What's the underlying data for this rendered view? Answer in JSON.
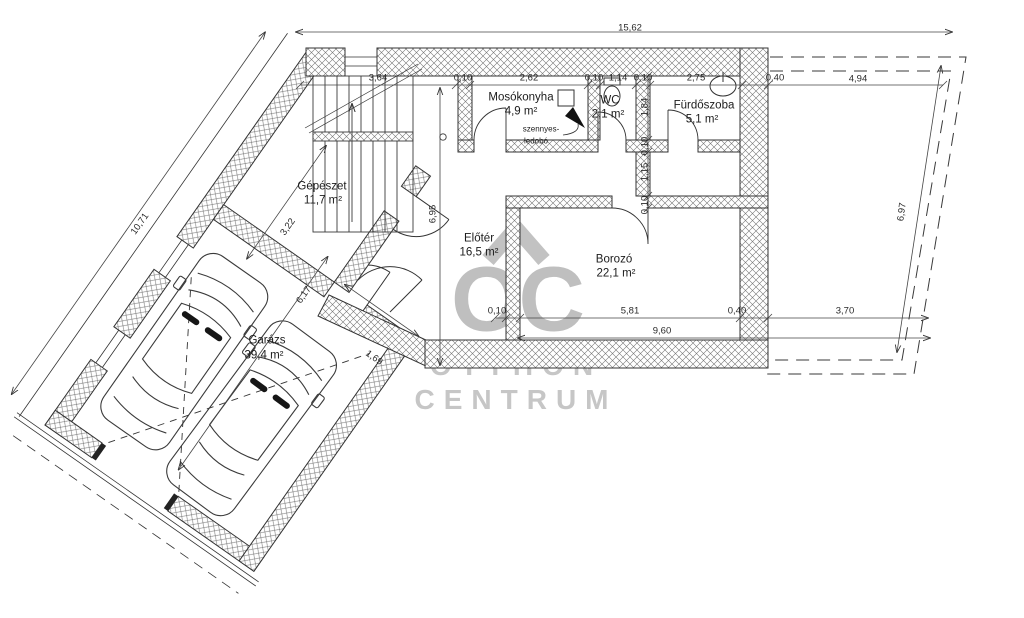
{
  "brand": {
    "oc": "OC",
    "line1": "OTTHON",
    "line2": "CENTRUM"
  },
  "rooms": {
    "mosokonyha": {
      "name": "Mosókonyha",
      "area": "4,9 m²"
    },
    "wc": {
      "name": "WC",
      "area": "2,1 m²"
    },
    "furdoszoba": {
      "name": "Fürdőszoba",
      "area": "5,1 m²"
    },
    "gepeszet": {
      "name": "Gépészet",
      "area": "11,7 m²"
    },
    "eloter": {
      "name": "Előtér",
      "area": "16,5 m²"
    },
    "borozo": {
      "name": "Borozó",
      "area": "22,1 m²"
    },
    "garazs": {
      "name": "Garázs",
      "area": "39,4 m²"
    }
  },
  "annotation": {
    "chute_line1": "szennyes-",
    "chute_line2": "ledobó"
  },
  "dims": {
    "overall_top": "15,62",
    "top_chain": [
      "3,64",
      "0,10",
      "2,62",
      "0,10",
      "1,14",
      "0,10",
      "2,75",
      "0,40",
      "4,94"
    ],
    "left": "10,71",
    "diag1": "3,22",
    "diag2": "6,17",
    "diag3": "1,69",
    "v_eloter": "6,95",
    "v_chain": [
      "1,84",
      "0,10",
      "1,15",
      "0,10"
    ],
    "right": "6,97",
    "bottom_chain": [
      "0,10",
      "5,81",
      "0,40",
      "3,70"
    ],
    "bottom_total": "9,60"
  },
  "colors": {
    "line": "#333333",
    "watermark": "#c2c2c2",
    "wall_hatch": "#777777"
  }
}
